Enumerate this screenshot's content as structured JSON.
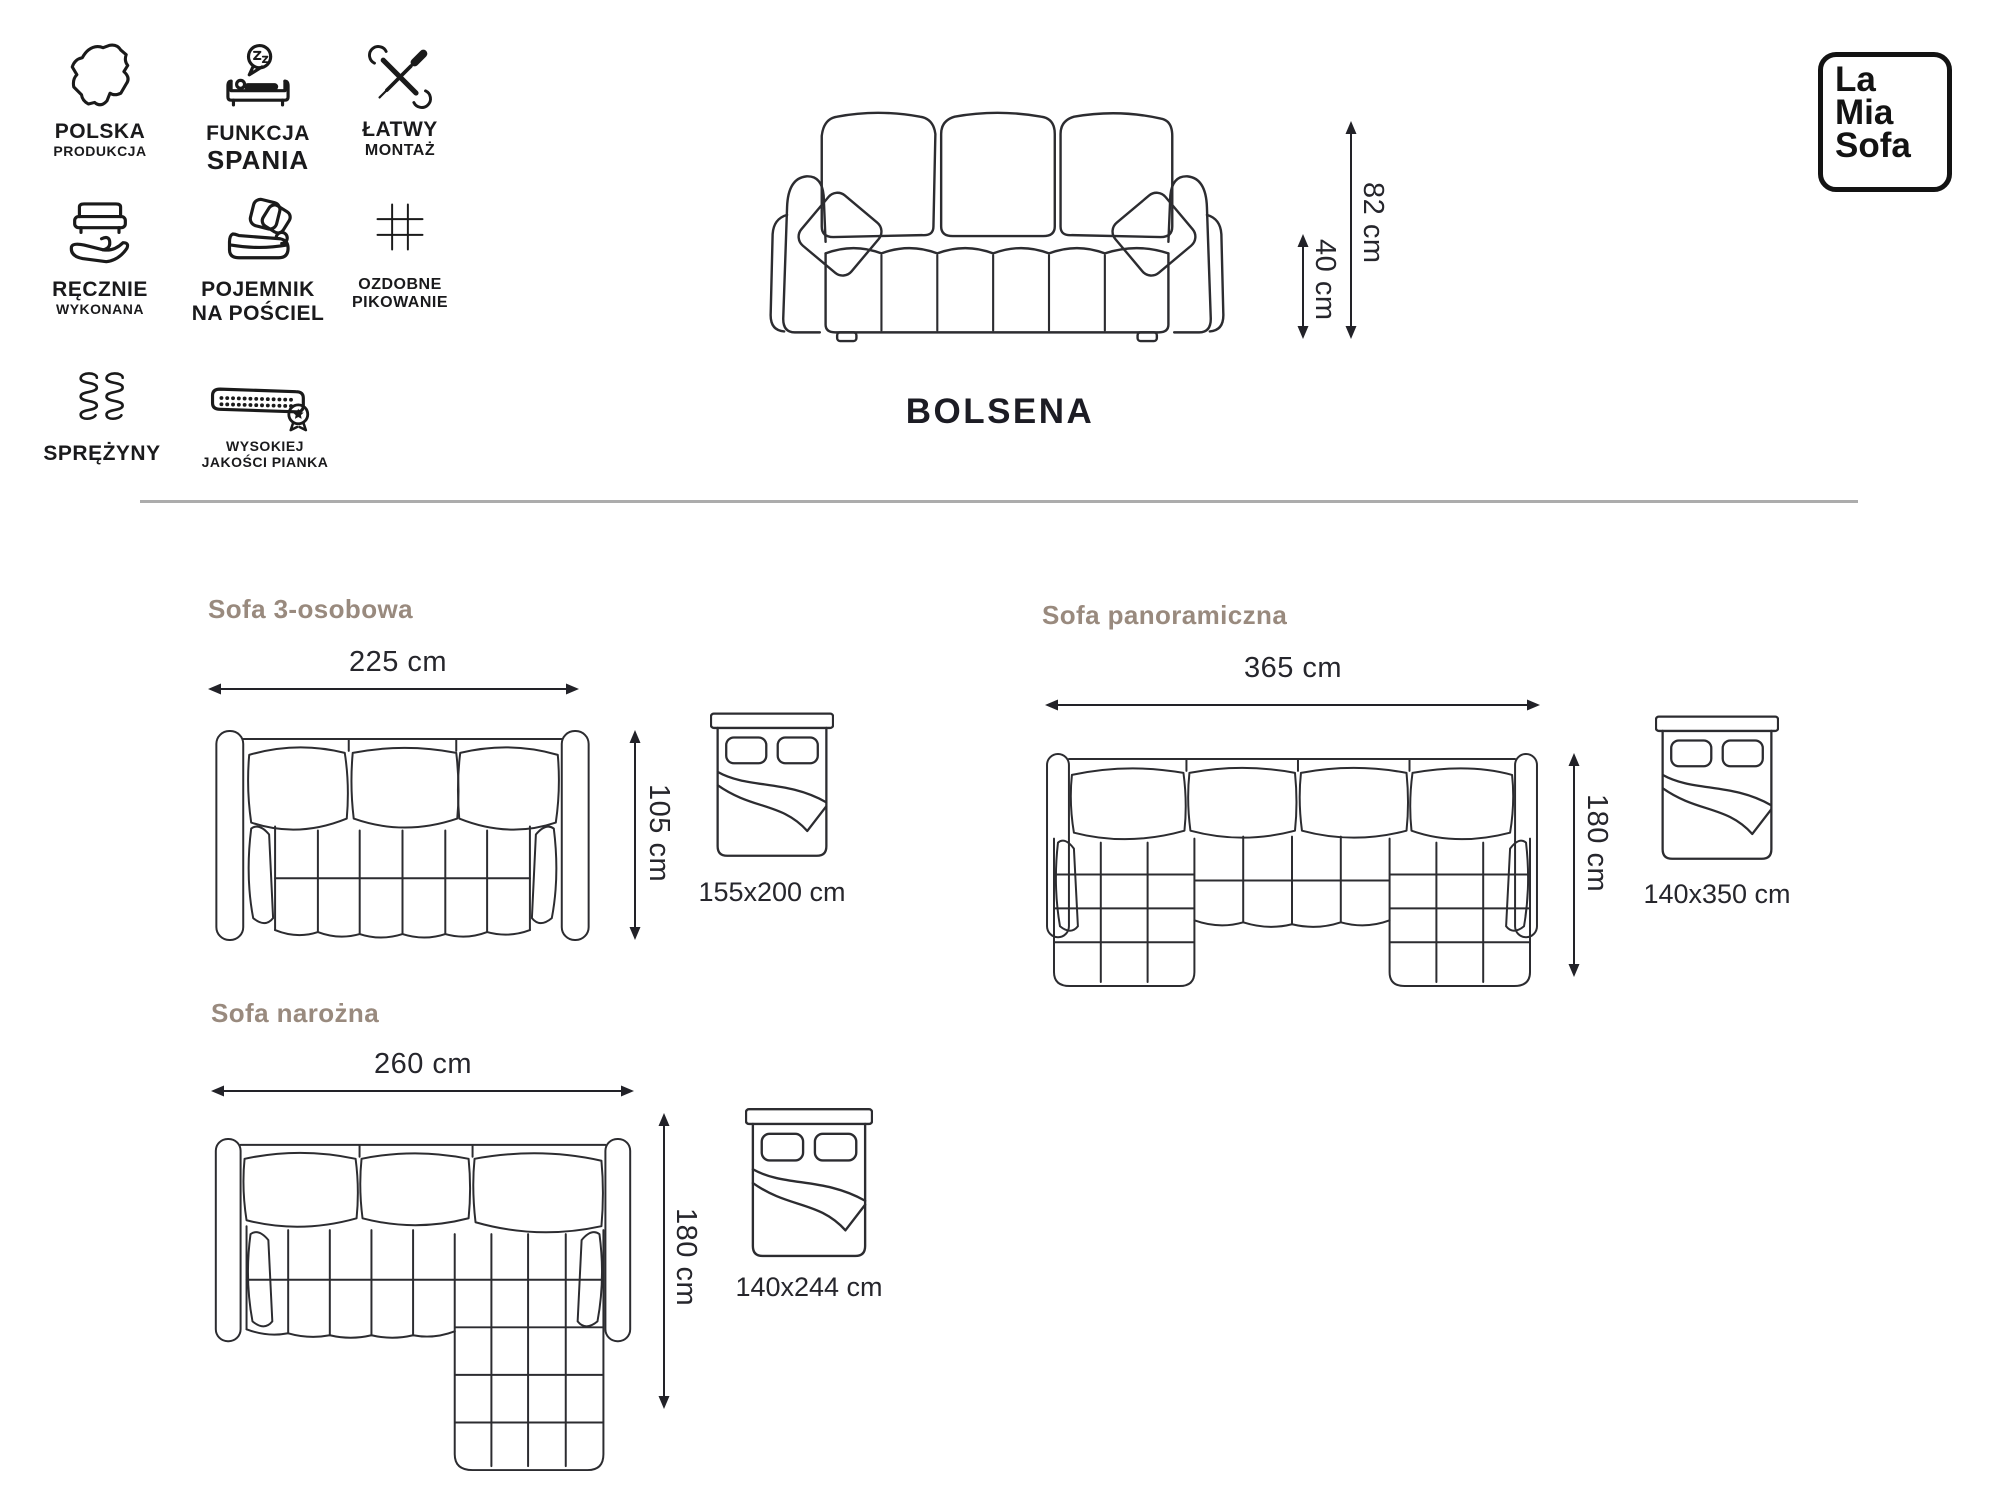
{
  "brand": {
    "line1": "La",
    "line2": "Mia",
    "line3": "Sofa"
  },
  "product": {
    "name": "BOLSENA"
  },
  "front_view": {
    "height_label": "82 cm",
    "seat_height_label": "40 cm"
  },
  "features": [
    {
      "icon": "poland-map-icon",
      "line1": "POLSKA",
      "line2": "PRODUKCJA"
    },
    {
      "icon": "sleep-function-icon",
      "line1": "FUNKCJA",
      "line2": "SPANIA"
    },
    {
      "icon": "easy-assembly-icon",
      "line1": "ŁATWY",
      "line2": "MONTAŻ"
    },
    {
      "icon": "handmade-icon",
      "line1": "RĘCZNIE",
      "line2": "WYKONANA"
    },
    {
      "icon": "bedding-storage-icon",
      "line1": "POJEMNIK",
      "line2": "NA POŚCIEL"
    },
    {
      "icon": "quilting-grid-icon",
      "line1": "OZDOBNE",
      "line2": "PIKOWANIE"
    },
    {
      "icon": "springs-icon",
      "line1": "SPRĘŻYNY",
      "line2": ""
    },
    {
      "icon": "foam-quality-icon",
      "line1": "WYSOKIEJ",
      "line2": "JAKOŚCI PIANKA"
    }
  ],
  "variants": [
    {
      "title": "Sofa 3-osobowa",
      "width_label": "225 cm",
      "depth_label": "105 cm",
      "bed_label": "155x200 cm"
    },
    {
      "title": "Sofa panoramiczna",
      "width_label": "365 cm",
      "depth_label": "180 cm",
      "bed_label": "140x350 cm"
    },
    {
      "title": "Sofa narożna",
      "width_label": "260 cm",
      "depth_label": "180 cm",
      "bed_label": "140x244 cm"
    }
  ],
  "colors": {
    "accent_heading": "#998a7e",
    "ink": "#26262c",
    "line_art": "#2c2c30",
    "divider": "#acacac"
  }
}
